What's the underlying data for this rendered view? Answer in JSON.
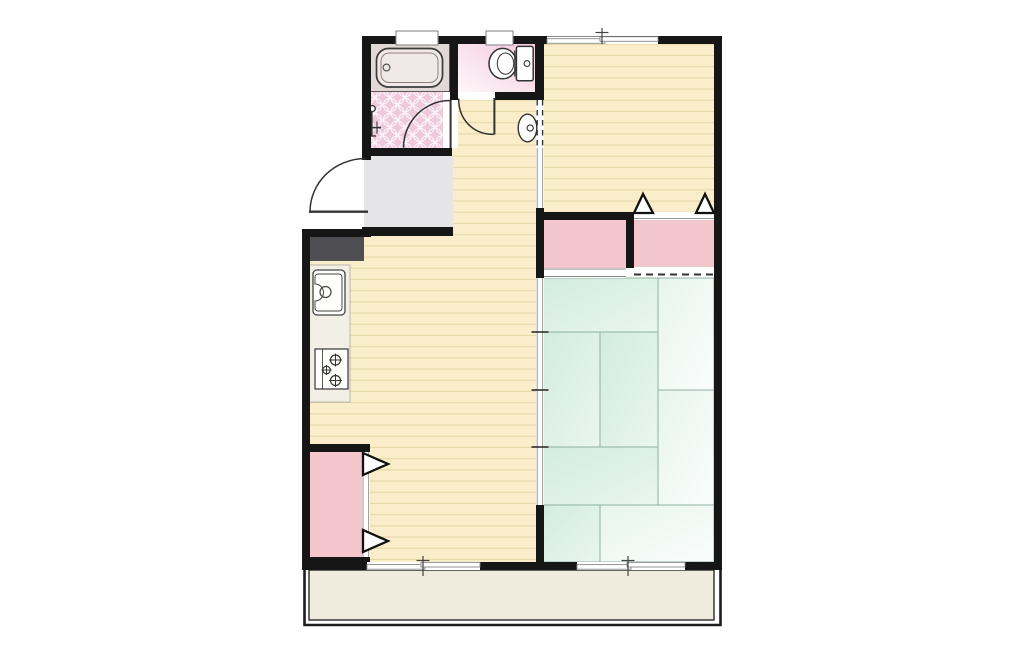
{
  "canvas": {
    "width": 1024,
    "height": 658,
    "background": "#ffffff"
  },
  "colors": {
    "wall": "#161616",
    "wood": "#f9eec9",
    "wood_line": "#e5d7a8",
    "genkan": "#e5e4e6",
    "step": "#4f4f53",
    "counter": "#f2efe6",
    "bath_surround": "#e3d8d8",
    "bathtub": "#f1e8e8",
    "washroom_tile": "#eec8db",
    "toilet_floor_dark": "#f3cbdd",
    "toilet_floor_light": "#fdf7f9",
    "closet_pink": "#f3c6ce",
    "tatami_green": "#d3ecdf",
    "tatami_green_light": "#e9f6ef",
    "tatami_white": "#fbfdfc",
    "tatami_line": "#8fb0a3",
    "balcony": "#efecdd",
    "fixture_line": "#333333",
    "window_line": "#8a8a8a"
  },
  "floorplan": {
    "rooms": [
      {
        "name": "bathroom",
        "fixtures": [
          "bathtub",
          "shower-tap"
        ],
        "floor": "washroom_tile"
      },
      {
        "name": "toilet-room",
        "fixtures": [
          "toilet"
        ],
        "floor": "toilet gradient"
      },
      {
        "name": "entrance-genkan",
        "fixtures": [
          "entry-step"
        ],
        "floor": "genkan"
      },
      {
        "name": "hallway",
        "fixtures": [
          "hand-basin"
        ],
        "floor": "wood"
      },
      {
        "name": "kitchen-dining",
        "fixtures": [
          "kitchen-counter",
          "kitchen-sink",
          "gas-stove",
          "closet-folding"
        ],
        "floor": "wood"
      },
      {
        "name": "bedroom",
        "fixtures": [
          "closet",
          "closet-folding"
        ],
        "floor": "wood"
      },
      {
        "name": "tatami-room",
        "mats": 8,
        "floor": "tatami_green"
      },
      {
        "name": "balcony",
        "floor": "balcony"
      }
    ],
    "openings": [
      "entrance-door",
      "washroom-door",
      "toilet-door",
      "bedroom-sliding-door",
      "tatami-sliding-partition",
      "closet-sliding-door",
      "folding-closet-doors",
      "bathroom-window",
      "toilet-window",
      "bedroom-window",
      "dk-balcony-window",
      "tatami-balcony-window"
    ]
  }
}
